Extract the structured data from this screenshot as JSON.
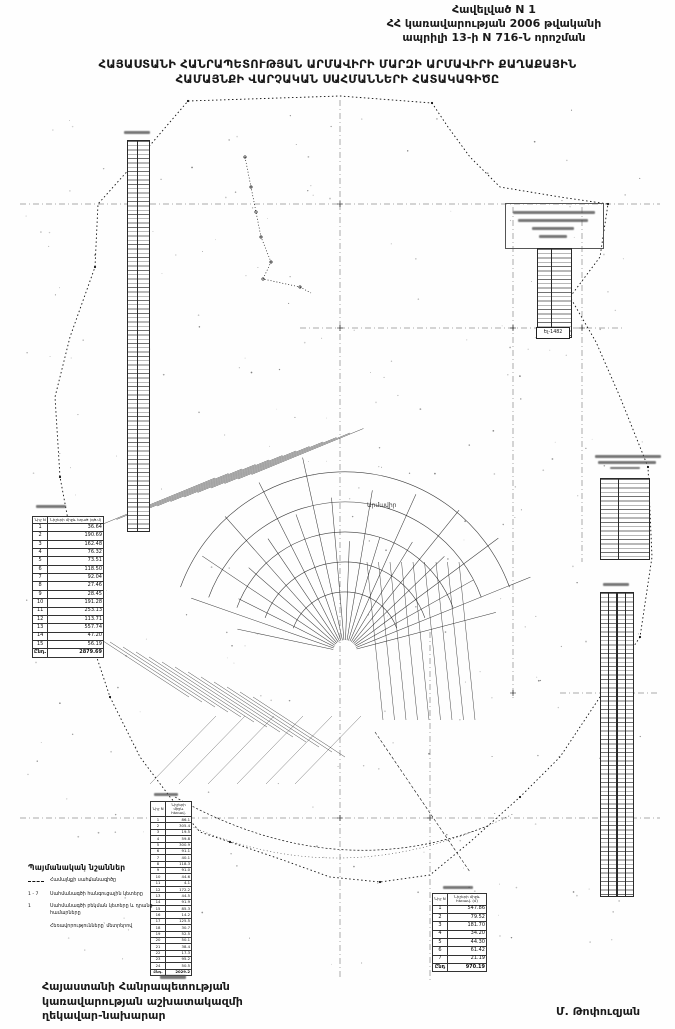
{
  "colors": {
    "ink": "#1a1a1a",
    "paper": "#ffffff"
  },
  "document": {
    "annex": {
      "line1": "Հավելված N 1",
      "line2": "ՀՀ կառավարության 2006 թվականի",
      "line3": "ապրիլի 13-ի N 716-Ն որոշման"
    },
    "title": {
      "line1": "ՀԱՅԱՍՏԱՆԻ ՀԱՆՐԱՊԵՏՈՒԹՅԱՆ ԱՐՄԱՎԻՐԻ ՄԱՐԶԻ ԱՐՄԱՎԻՐԻ ՔԱՂԱՔԱՅԻՆ",
      "line2": "ՀԱՄԱՅՆՔԻ ՎԱՐՉԱԿԱՆ ՍԱՀՄԱՆՆԵՐԻ ՀԱՏԱԿԱԳԻԾԸ"
    },
    "footer": {
      "line1": "Հայաստանի Հանրապետության",
      "line2": "կառավարության աշխատակազմի",
      "line3": "ղեկավար-նախարար",
      "signature": "Մ. Թոփուզյան"
    }
  },
  "map": {
    "city_label": "Արմավիր",
    "point_box_label": "Ել-1482"
  },
  "legend": {
    "title": "Պայմանական նշաններ",
    "items": [
      {
        "symbol": "dashdot-line",
        "label": "Համայնքի սահմանագիծը"
      },
      {
        "symbol": "1 - 7",
        "label": "Սահմանագծի հանգուցային կետերը"
      },
      {
        "symbol": "1",
        "label": "Սահմանագծի բեկման կետերը և դրանց համարները"
      },
      {
        "symbol": "",
        "label": "Հեռավորությունները՝ մետրերով"
      }
    ]
  },
  "tables": {
    "t_left": {
      "headers": [
        "Նիշ N",
        "Նիշերի միջև եղած (գծ.մ)"
      ],
      "rows": [
        [
          "1",
          "36.64"
        ],
        [
          "2",
          "190.69"
        ],
        [
          "3",
          "162.48"
        ],
        [
          "4",
          "76.32"
        ],
        [
          "5",
          "73.51"
        ],
        [
          "6",
          "118.50"
        ],
        [
          "7",
          "92.04"
        ],
        [
          "8",
          "27.46"
        ],
        [
          "9",
          "28.45"
        ],
        [
          "10",
          "191.28"
        ],
        [
          "11",
          "253.13"
        ],
        [
          "12",
          "113.71"
        ],
        [
          "13",
          "557.74"
        ],
        [
          "14",
          "47.20"
        ],
        [
          "15",
          "56.19"
        ]
      ],
      "total": [
        "Ընդ.",
        "2879.69"
      ]
    },
    "t_bottom_left": {
      "headers": [
        "Նիշ N",
        "Նիշերի միջև հեռավ."
      ],
      "rows": [
        [
          "1",
          "86.1"
        ],
        [
          "2",
          "305.4"
        ],
        [
          "3",
          "19.5"
        ],
        [
          "4",
          "59.8"
        ],
        [
          "5",
          "300.9"
        ],
        [
          "6",
          "91.1"
        ],
        [
          "7",
          "40.1"
        ],
        [
          "8",
          "118.3"
        ],
        [
          "9",
          "91.0"
        ],
        [
          "10",
          "44.6"
        ],
        [
          "11",
          "4.1"
        ],
        [
          "12",
          "172.2"
        ],
        [
          "13",
          "44.5"
        ],
        [
          "14",
          "91.9"
        ],
        [
          "15",
          "85.3"
        ],
        [
          "16",
          "14.2"
        ],
        [
          "17",
          "125.5"
        ],
        [
          "18",
          "30.7"
        ],
        [
          "19",
          "52.5"
        ],
        [
          "20",
          "50.1"
        ],
        [
          "21",
          "38.4"
        ],
        [
          "22",
          "17.3"
        ],
        [
          "23",
          "95.2"
        ],
        [
          "24",
          "50.5"
        ]
      ],
      "total": [
        "Ընդ.",
        "2029.2"
      ]
    },
    "t_bottom_center": {
      "headers": [
        "Նիշ N",
        "Նիշերի միջև հեռավ. (մ)"
      ],
      "rows": [
        [
          "1",
          "547.86"
        ],
        [
          "2",
          "79.52"
        ],
        [
          "3",
          "181.70"
        ],
        [
          "4",
          "34.20"
        ],
        [
          "5",
          "44.30"
        ],
        [
          "6",
          "61.42"
        ],
        [
          "7",
          "21.19"
        ]
      ],
      "total": [
        "Ընդ",
        "970.19"
      ]
    }
  }
}
